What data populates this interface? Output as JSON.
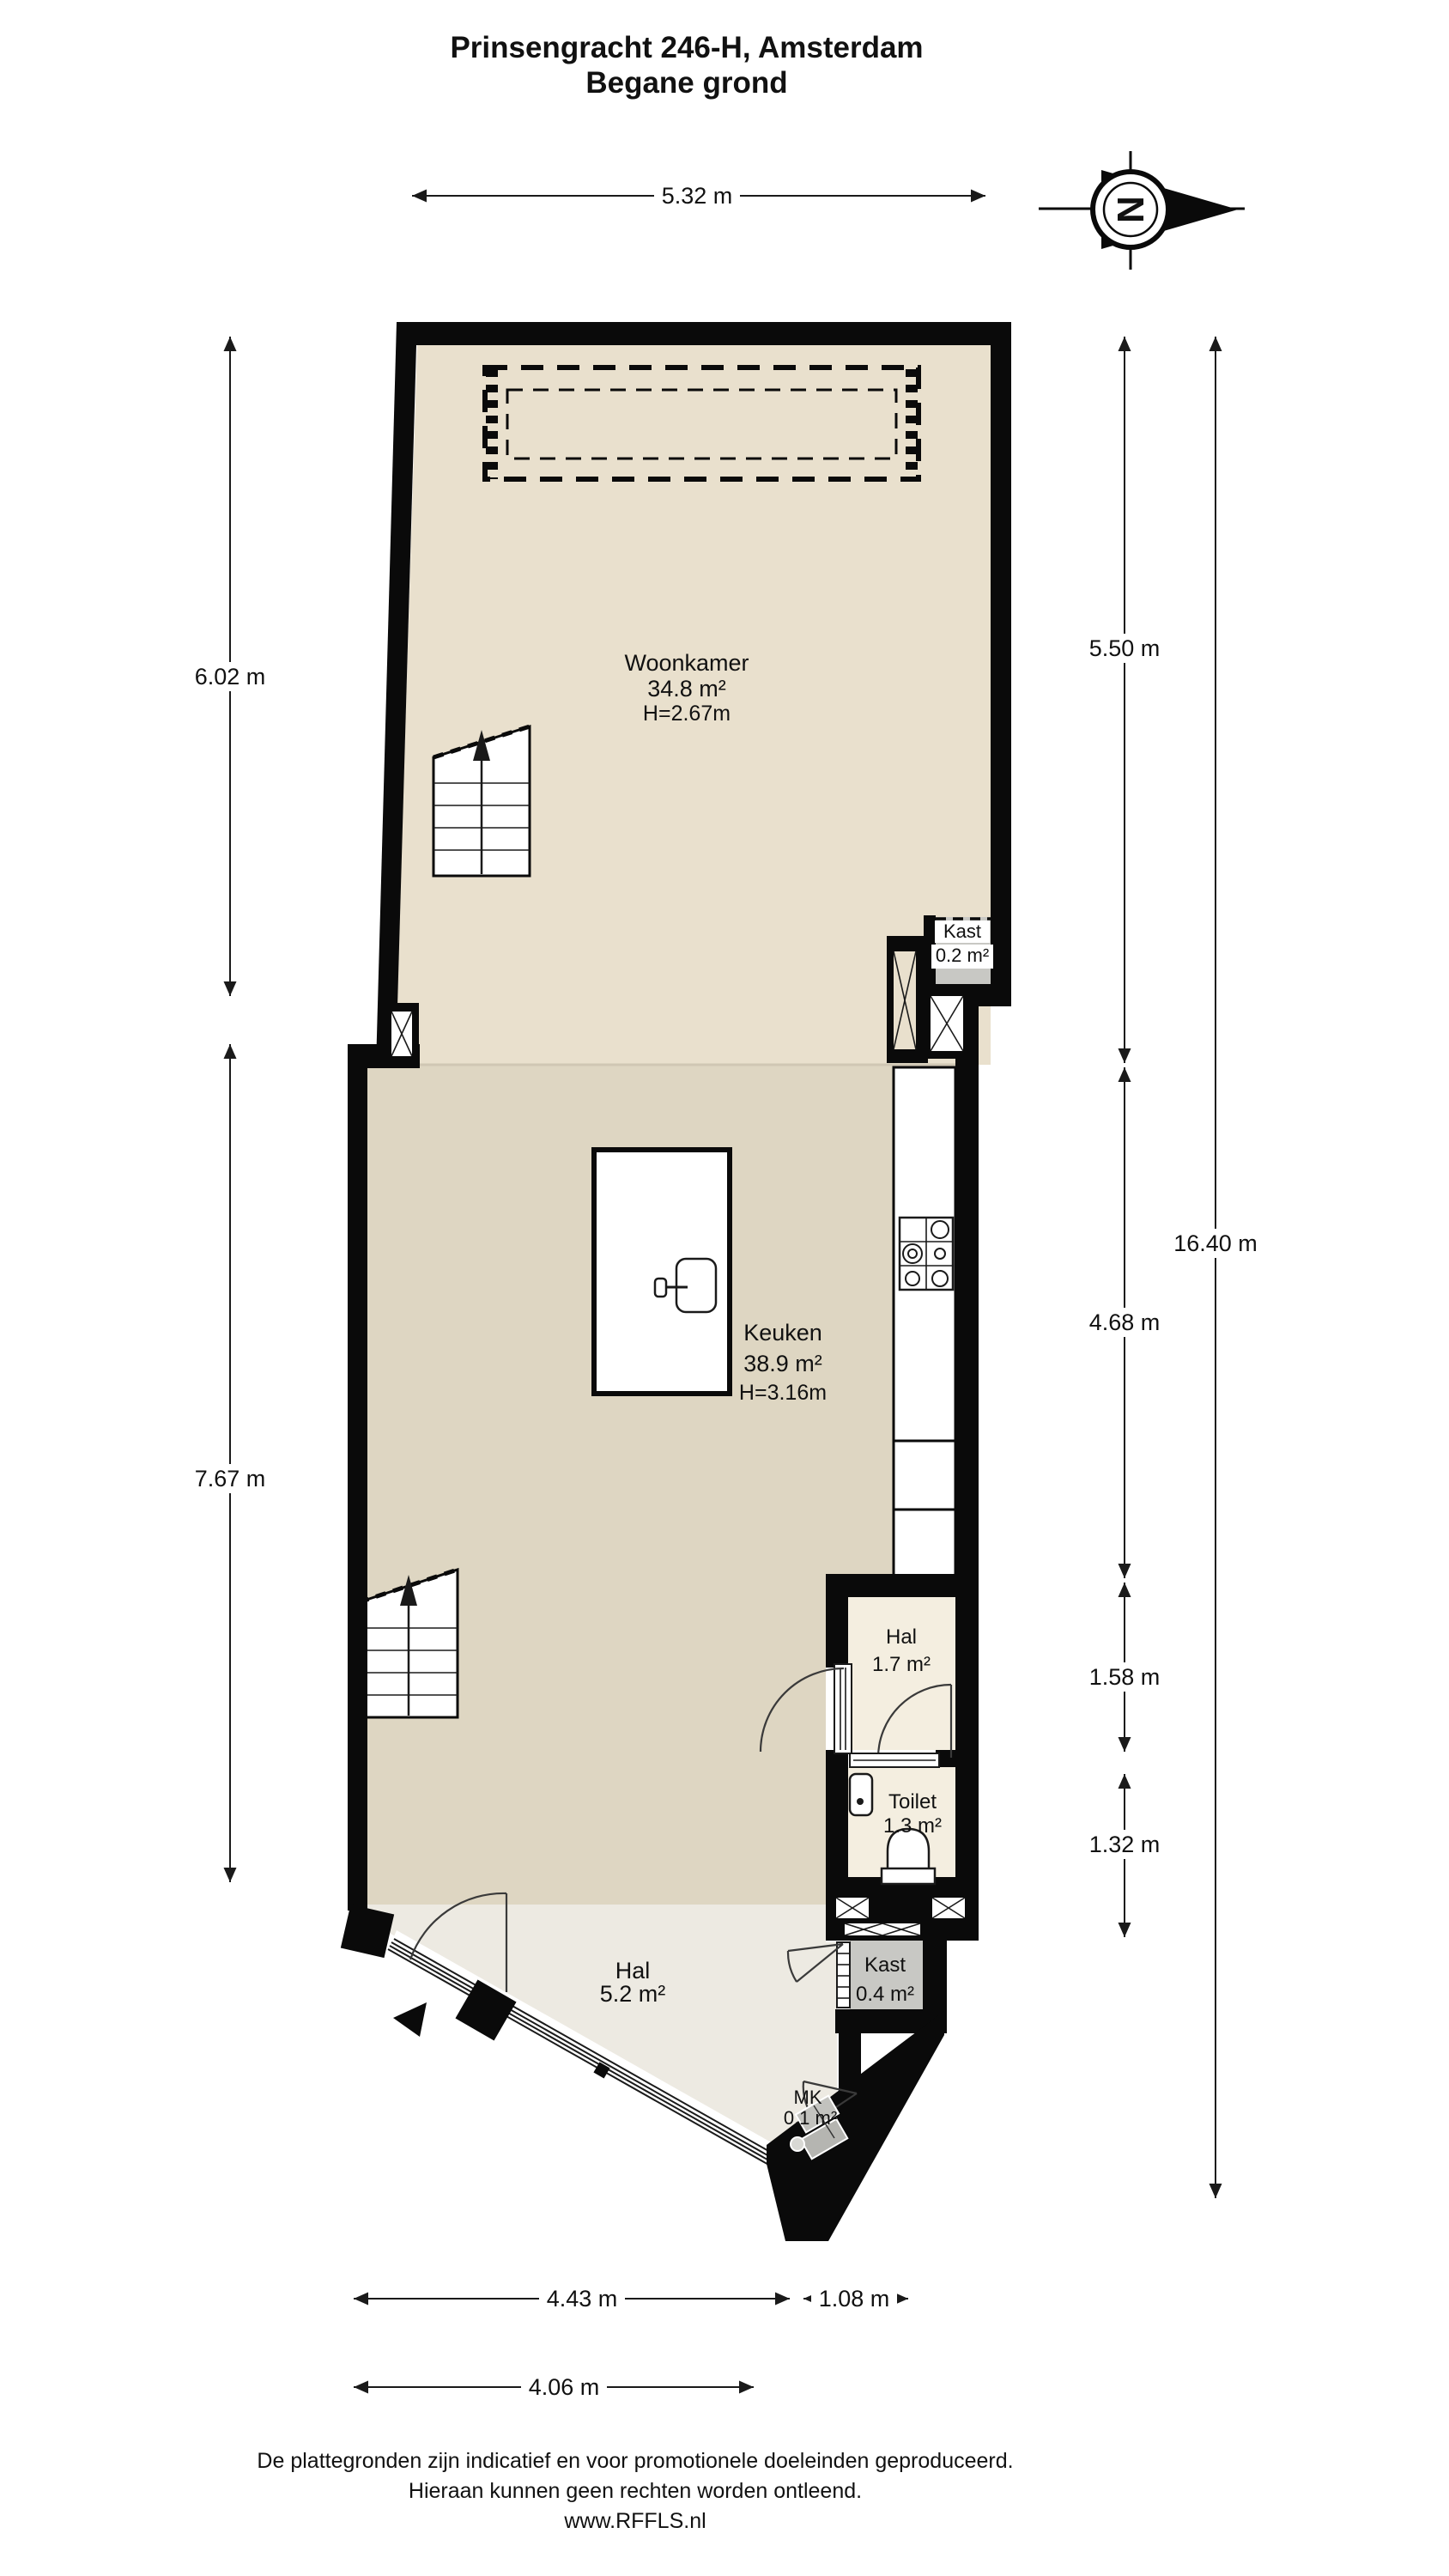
{
  "title": {
    "line1": "Prinsengracht 246-H, Amsterdam",
    "line2": "Begane grond"
  },
  "compass": {
    "letter": "N"
  },
  "rooms": {
    "woonkamer": {
      "name": "Woonkamer",
      "area": "34.8 m²",
      "height": "H=2.67m"
    },
    "kast_boven": {
      "name": "Kast",
      "area": "0.2 m²"
    },
    "keuken": {
      "name": "Keuken",
      "area": "38.9 m²",
      "height": "H=3.16m"
    },
    "hal_klein": {
      "name": "Hal",
      "area": "1.7 m²"
    },
    "toilet": {
      "name": "Toilet",
      "area": "1.3 m²"
    },
    "hal_groot": {
      "name": "Hal",
      "area": "5.2 m²"
    },
    "kast_onder": {
      "name": "Kast",
      "area": "0.4 m²"
    },
    "mk": {
      "name": "MK",
      "area": "0.1 m²"
    }
  },
  "dimensions": {
    "top": "5.32 m",
    "left_upper": "6.02 m",
    "left_lower": "7.67 m",
    "right_upper": "5.50 m",
    "right_mid": "4.68 m",
    "right_hal": "1.58 m",
    "right_toilet": "1.32 m",
    "right_total": "16.40 m",
    "bottom_left": "4.43 m",
    "bottom_right": "1.08 m",
    "bottom_lower": "4.06 m"
  },
  "footer": {
    "line1": "De plattegronden zijn indicatief en voor promotionele doeleinden geproduceerd.",
    "line2": "Hieraan kunnen geen rechten worden ontleend.",
    "line3": "www.RFFLS.nl"
  },
  "colors": {
    "wall": "#0a0a0a",
    "floor_woonkamer": "#e9e0cd",
    "floor_keuken": "#ded6c2",
    "floor_hal_klein": "#f4eee0",
    "floor_hal_groot": "#edeae2",
    "floor_kast": "#c8c8c4",
    "fixture_white": "#ffffff"
  }
}
